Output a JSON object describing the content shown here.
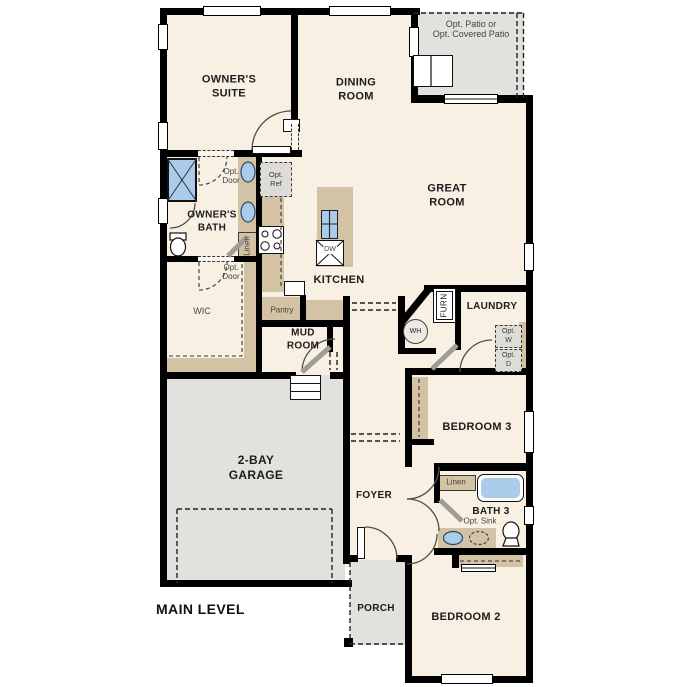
{
  "plan": {
    "title": "MAIN LEVEL",
    "rooms": {
      "owners_suite": {
        "l1": "OWNER'S",
        "l2": "SUITE"
      },
      "dining": {
        "l1": "DINING",
        "l2": "ROOM"
      },
      "great": {
        "l1": "GREAT",
        "l2": "ROOM"
      },
      "owners_bath": {
        "l1": "OWNER'S",
        "l2": "BATH"
      },
      "kitchen": "KITCHEN",
      "wic": "WIC",
      "pantry": "Pantry",
      "mud": {
        "l1": "MUD",
        "l2": "ROOM"
      },
      "laundry": "LAUNDRY",
      "garage": {
        "l1": "2-BAY",
        "l2": "GARAGE"
      },
      "foyer": "FOYER",
      "porch": "PORCH",
      "bedroom3": "BEDROOM 3",
      "bath3": "BATH 3",
      "bedroom2": "BEDROOM 2"
    },
    "labels": {
      "opt_patio": {
        "l1": "Opt. Patio or",
        "l2": "Opt. Covered Patio"
      },
      "opt_door": {
        "l1": "Opt.",
        "l2": "Door"
      },
      "opt_ref": {
        "l1": "Opt.",
        "l2": "Ref"
      },
      "opt_w": {
        "l1": "Opt.",
        "l2": "W"
      },
      "opt_d": {
        "l1": "Opt.",
        "l2": "D"
      },
      "opt_sink": "Opt. Sink",
      "linen": "Linen",
      "furn": "FURN",
      "wh": "WH",
      "dw": "DW"
    },
    "colors": {
      "wall": "#000000",
      "room_fill": "#f8f0e3",
      "concrete_fill": "#e3e1dd",
      "casework_fill": "#d3c2a4",
      "fixture_blue": "#aacbea",
      "annotation_text": "#45453f",
      "room_text": "#1c1c1c"
    }
  }
}
